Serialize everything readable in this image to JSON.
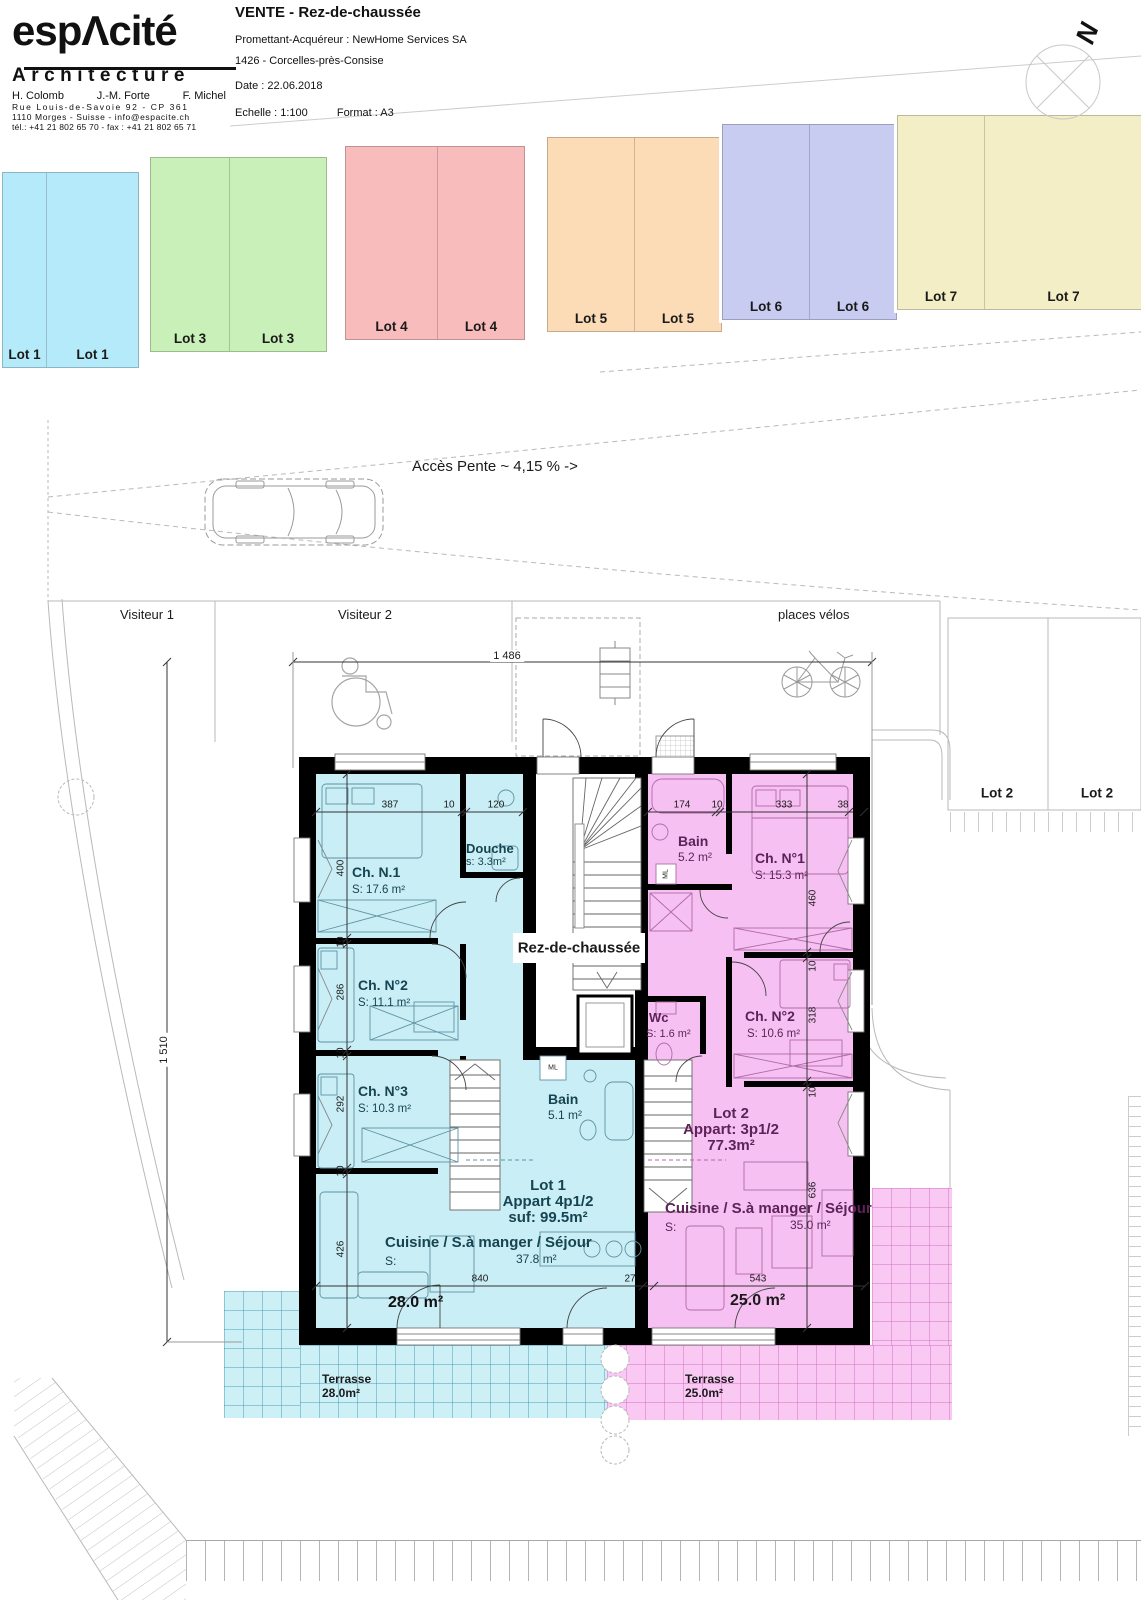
{
  "letterhead": {
    "brand": "espΛcité",
    "brand_sub": "Architecture",
    "partner1": "H. Colomb",
    "partner2": "J.-M. Forte",
    "partner3": "F. Michel",
    "address1": "Rue Louis-de-Savoie 92 - CP 361",
    "address2": "1110 Morges - Suisse - info@espacite.ch",
    "address3": "tél.: +41 21 802 65 70  -  fax : +41 21 802 65 71"
  },
  "title_block": {
    "title": "VENTE - Rez-de-chaussée",
    "client": "Promettant-Acquéreur : NewHome Services SA",
    "project": "1426 - Corcelles-près-Consise",
    "date": "Date : 22.06.2018",
    "scale": "Echelle : 1:100",
    "format": "Format : A3"
  },
  "north_label": "N",
  "site": {
    "access_note": "Accès Pente ~ 4,15 % ->",
    "visitor_1": "Visiteur 1",
    "visitor_2": "Visiteur 2",
    "bike_area": "places vélos",
    "overall_width": "1 486",
    "overall_depth": "1 510",
    "parking_strips": [
      {
        "label": "Lot 1",
        "color": "#b5eafa"
      },
      {
        "label": "Lot 3",
        "color": "#c9f0b8"
      },
      {
        "label": "Lot 4",
        "color": "#f8bcbc"
      },
      {
        "label": "Lot 5",
        "color": "#fcdbb7"
      },
      {
        "label": "Lot 6",
        "color": "#c9ccf1"
      },
      {
        "label": "Lot 7",
        "color": "#f4eec6"
      }
    ],
    "lot2_parking_left": "Lot 2",
    "lot2_parking_right": "Lot 2"
  },
  "plan": {
    "floor_label": "Rez-de-chaussée",
    "ml": "ML",
    "lot1": {
      "bedroom1_name": "Ch. N.1",
      "bedroom1_area": "S: 17.6 m²",
      "shower_name": "Douche",
      "shower_area": "s: 3.3m²",
      "bedroom2_name": "Ch. N°2",
      "bedroom2_area": "S: 11.1 m²",
      "bedroom3_name": "Ch. N°3",
      "bedroom3_area": "S: 10.3 m²",
      "bath_name": "Bain",
      "bath_area": "5.1 m²",
      "unit_line1": "Lot 1",
      "unit_line2": "Appart 4p1/2",
      "unit_line3": "suf: 99.5m²",
      "living_name": "Cuisine / S.à manger / Séjour",
      "living_s": "S:",
      "living_area": "37.8 m²",
      "living_size": "28.0 m²",
      "terrace_name": "Terrasse",
      "terrace_area": "28.0m²"
    },
    "lot2": {
      "bath_name": "Bain",
      "bath_area": "5.2 m²",
      "bedroom1_name": "Ch. N°1",
      "bedroom1_area": "S: 15.3 m²",
      "wc_name": "Wc",
      "wc_area": "S: 1.6 m²",
      "bedroom2_name": "Ch. N°2",
      "bedroom2_area": "S: 10.6 m²",
      "unit_line1": "Lot 2",
      "unit_line2": "Appart: 3p1/2",
      "unit_line3": "77.3m²",
      "living_name": "Cuisine / S.à manger / Séjour",
      "living_s": "S:",
      "living_area": "35.0 m²",
      "living_size": "25.0 m²",
      "terrace_name": "Terrasse",
      "terrace_area": "25.0m²"
    },
    "dims": {
      "lot1_top": [
        "387",
        "10",
        "120"
      ],
      "lot2_top": [
        "174",
        "10",
        "333",
        "38"
      ],
      "lot1_left": [
        "400",
        "10",
        "286",
        "10",
        "292",
        "10",
        "426"
      ],
      "lot2_right": [
        "460",
        "10",
        "318",
        "10",
        "636"
      ],
      "lot1_bottom": [
        "840",
        "27"
      ],
      "lot2_bottom": [
        "543"
      ]
    }
  },
  "colors": {
    "wall": "#000000",
    "lot1_fill": "#c9eef6",
    "lot2_fill": "#f7c0f2",
    "terrace1_fill": "#cdeff6",
    "terrace2_fill": "#f9c9f4"
  }
}
